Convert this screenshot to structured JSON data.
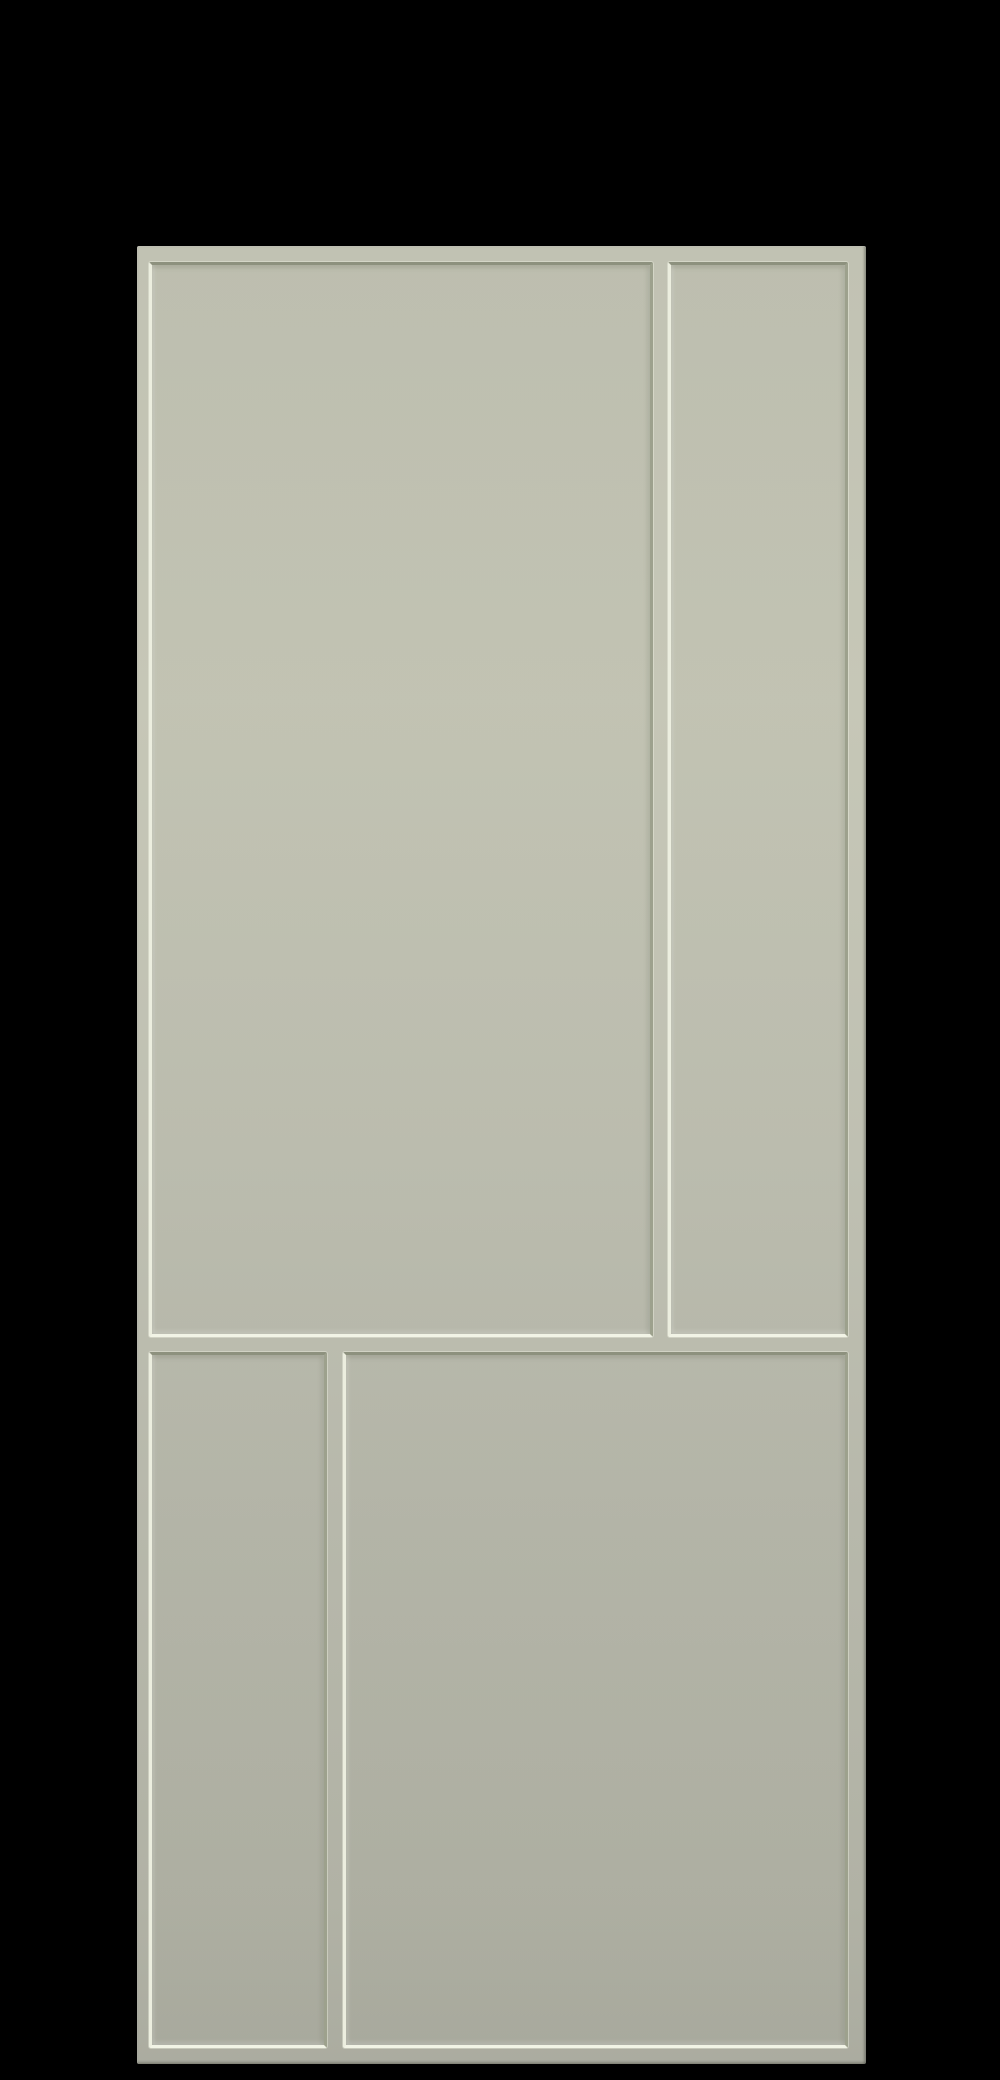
{
  "scene": {
    "subject": "Sage green interior door with four recessed shaker-style panels on a black background",
    "background": "solid black",
    "door": {
      "finish": "matte sage green",
      "style": "flat shaker frame with thin stiles and rails, recessed flat panels",
      "panel_count": 4,
      "panels": [
        {
          "id": "upper-left",
          "description": "large tall rectangular panel"
        },
        {
          "id": "upper-right",
          "description": "narrow tall rectangular panel"
        },
        {
          "id": "lower-left",
          "description": "narrow short rectangular panel"
        },
        {
          "id": "lower-right",
          "description": "wide short rectangular panel"
        }
      ],
      "hardware": "none visible"
    }
  },
  "theme": {
    "background": "#000000",
    "face-top": "#c1c2b3",
    "face-upper": "#c6c7b7",
    "face-mid": "#bfc0b2",
    "face-lower": "#b7b8ab",
    "face-low2": "#b1b2a5",
    "face-bottom": "#abaca0",
    "bevel-shadow": "#8d917e",
    "bevel-shadow-soft": "#9da18d",
    "bevel-highlight": "#eceedf",
    "bevel-highlight-strong": "#f2f4e6"
  }
}
